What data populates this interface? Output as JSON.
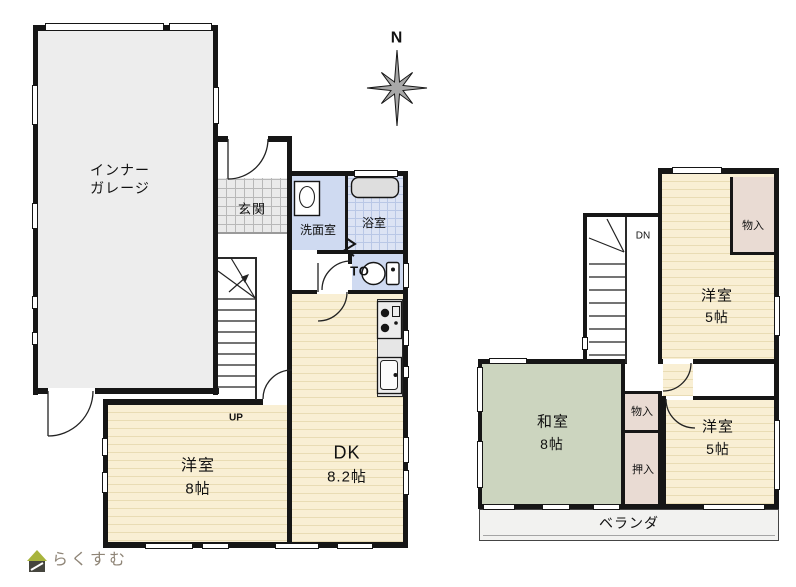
{
  "title": "2-story house floor plan",
  "compass": {
    "north_label": "N"
  },
  "logo": {
    "text": "らくすむ"
  },
  "floor1": {
    "garage_label": "インナー\nガレージ",
    "entrance": "玄関",
    "washroom": "洗面室",
    "bathroom": "浴室",
    "toilet": "TO",
    "dk_name": "DK",
    "dk_size": "8.2帖",
    "bedroom_name": "洋室",
    "bedroom_size": "8帖",
    "stairs_up": "UP"
  },
  "floor2": {
    "stairs_down": "DN",
    "bedroom_top_name": "洋室",
    "bedroom_top_size": "5帖",
    "storage_top": "物入",
    "washitsu_name": "和室",
    "washitsu_size": "8帖",
    "storage_mid": "物入",
    "oshiire": "押入",
    "bedroom_bottom_name": "洋室",
    "bedroom_bottom_size": "5帖",
    "veranda": "ベランダ"
  },
  "colors": {
    "wall": "#161616",
    "garage_fill": "#ededed",
    "wet_fill": "#cfdaf1",
    "bath_fill": "#dce3f4",
    "bath_line": "#b9c7e6",
    "genkan_fill": "#eaeaea",
    "genkan_line": "#b8b8b8",
    "wood_fill": "#f9efd4",
    "wood_stripe": "#e9dcb4",
    "tatami_fill": "#ccd5bf",
    "closet_fill": "#e9dbd3",
    "counter_fill": "#e6e6e6",
    "veranda_fill": "#f2f2f0",
    "logo_color": "#8f8577",
    "logo_roof": "#a8b43c"
  }
}
